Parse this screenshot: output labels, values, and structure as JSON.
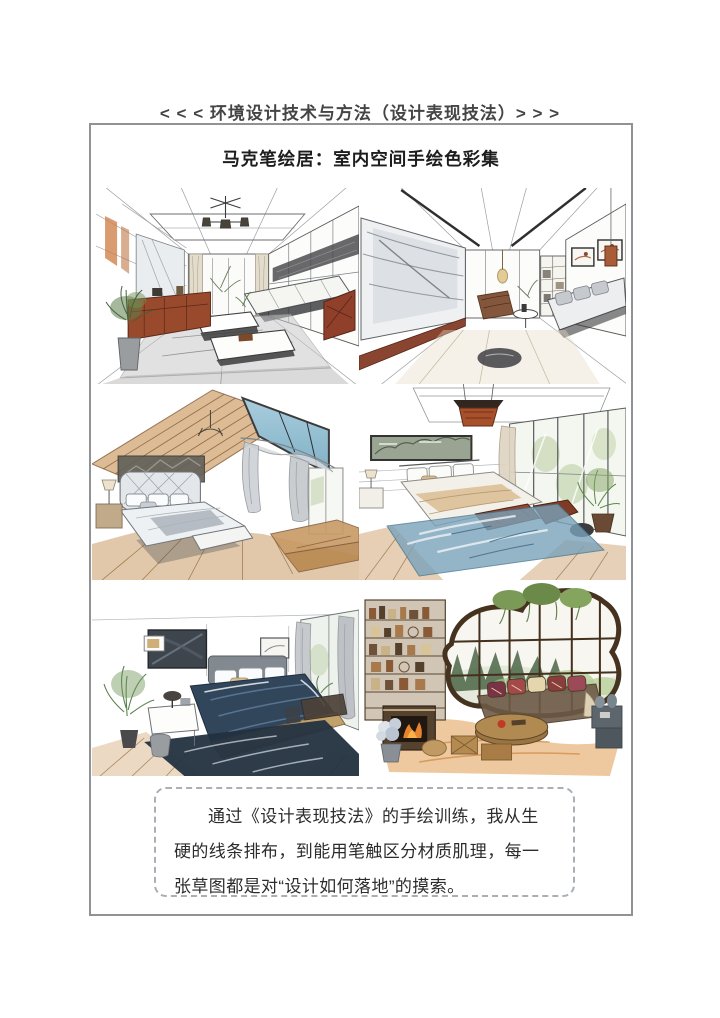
{
  "page": {
    "header": {
      "text": "< < < 环境设计技术与方法（设计表现技法）> > >"
    },
    "title": {
      "text": "马克笔绘居：室内空间手绘色彩集"
    },
    "gallery": {
      "items": [
        {
          "name": "living-room-one-point-perspective"
        },
        {
          "name": "living-room-tv-wall"
        },
        {
          "name": "attic-bedroom-skylight"
        },
        {
          "name": "bedroom-blue-rug"
        },
        {
          "name": "bedroom-navy-bedding"
        },
        {
          "name": "sunroom-organic-window"
        }
      ]
    },
    "caption": {
      "text": "通过《设计表现技法》的手绘训练，我从生硬的线条排布，到能用笔触区分材质肌理，每一张草图都是对“设计如何落地”的摸索。"
    },
    "colors": {
      "frame_border": "#8f9396",
      "caption_border": "#a9afb5",
      "heading_text": "#454545",
      "title_text": "#1d1d1d",
      "body_text": "#2c2c2c",
      "wood_tone": "#d8b287",
      "skylight_blue": "#8fb9d0",
      "rug_blue": "#7aa2ba",
      "navy_bedding": "#31455b",
      "mahogany_accent": "#8f3f2a",
      "warm_floor": "#e09c52"
    }
  }
}
